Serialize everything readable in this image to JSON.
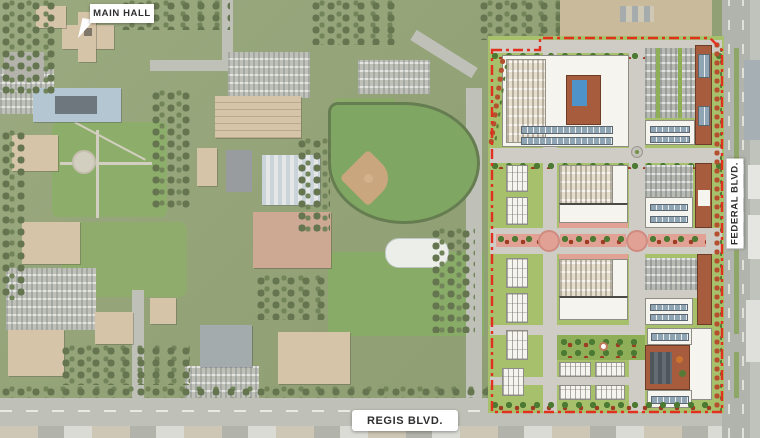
{
  "labels": {
    "main_hall": "MAIN HALL",
    "federal_blvd": "FEDERAL BLVD.",
    "regis_blvd": "REGIS BLVD."
  },
  "colors": {
    "boundary_red": "#e2301f",
    "aerial_green": "#87986a",
    "tree_green": "#55663f",
    "lawn_green": "#7da457",
    "road_gray": "#b7bab2",
    "building_tan": "#d2bda0",
    "plan_lawn": "#a6c06c",
    "plan_street": "#cfccc5",
    "plan_white": "#f6f4ee",
    "terracotta": "#a85c3e",
    "solar_blue": "#8fa5b4",
    "plaza_pink": "#e2a195",
    "pool_blue": "#4e93c9"
  },
  "map": {
    "type": "aerial-campus-with-development-site-plan",
    "boundary_style": "red dashed outline around proposed development parcel",
    "features": [
      "campus buildings",
      "quad lawn",
      "baseball field",
      "field house",
      "ice rink",
      "parking lots",
      "site plan blocks: apartments with pool courtyard, parking courts, townhouse rows, solar roofs, central paseo, park"
    ]
  }
}
